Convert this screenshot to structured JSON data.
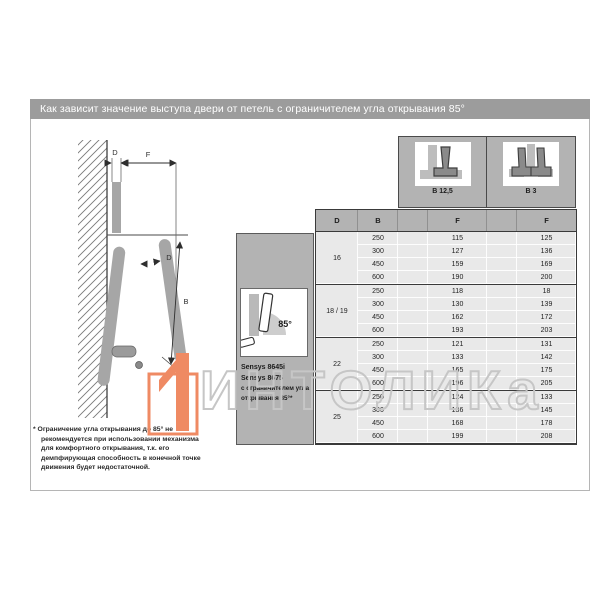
{
  "page": {
    "header_title": "Как зависит значение выступа двери от петель с ограничителем угла открывания 85°"
  },
  "hinge_variants": [
    {
      "label": "B 12,5",
      "icon": "hinge-overlay-icon"
    },
    {
      "label": "B 3",
      "icon": "hinge-twin-icon"
    }
  ],
  "product_box": {
    "angle_label": "85°",
    "model_lines": [
      "Sensys 8645i",
      "Sensys 8675"
    ],
    "caption_lines": [
      "с ограничителем угла",
      "открывания 85°*"
    ]
  },
  "diagram_labels": {
    "thickness_top": "D",
    "protrusion": "F",
    "thickness_mid": "D",
    "door_height": "B"
  },
  "table": {
    "columns": [
      "D",
      "B",
      "F",
      "F"
    ],
    "groups": [
      {
        "d": "16",
        "rows": [
          [
            "250",
            "115",
            "125"
          ],
          [
            "300",
            "127",
            "136"
          ],
          [
            "450",
            "159",
            "169"
          ],
          [
            "600",
            "190",
            "200"
          ]
        ]
      },
      {
        "d": "18 / 19",
        "rows": [
          [
            "250",
            "118",
            "18"
          ],
          [
            "300",
            "130",
            "139"
          ],
          [
            "450",
            "162",
            "172"
          ],
          [
            "600",
            "193",
            "203"
          ]
        ]
      },
      {
        "d": "22",
        "rows": [
          [
            "250",
            "121",
            "131"
          ],
          [
            "300",
            "133",
            "142"
          ],
          [
            "450",
            "165",
            "175"
          ],
          [
            "600",
            "196",
            "205"
          ]
        ]
      },
      {
        "d": "25",
        "rows": [
          [
            "250",
            "124",
            "133"
          ],
          [
            "300",
            "136",
            "145"
          ],
          [
            "450",
            "168",
            "178"
          ],
          [
            "600",
            "199",
            "208"
          ]
        ]
      }
    ]
  },
  "footnote_lines": [
    "* Ограничение угла открывания до 85° не",
    "рекомендуется при использовании механизма",
    "для комфортного открывания, т.к. его",
    "демпфирующая способность в конечной точке",
    "движения будет недостаточной."
  ],
  "watermark": {
    "text": "ИНТОЛИКа",
    "accent_color": "#ef8a63",
    "stroke_color": "#c6c6c6"
  }
}
